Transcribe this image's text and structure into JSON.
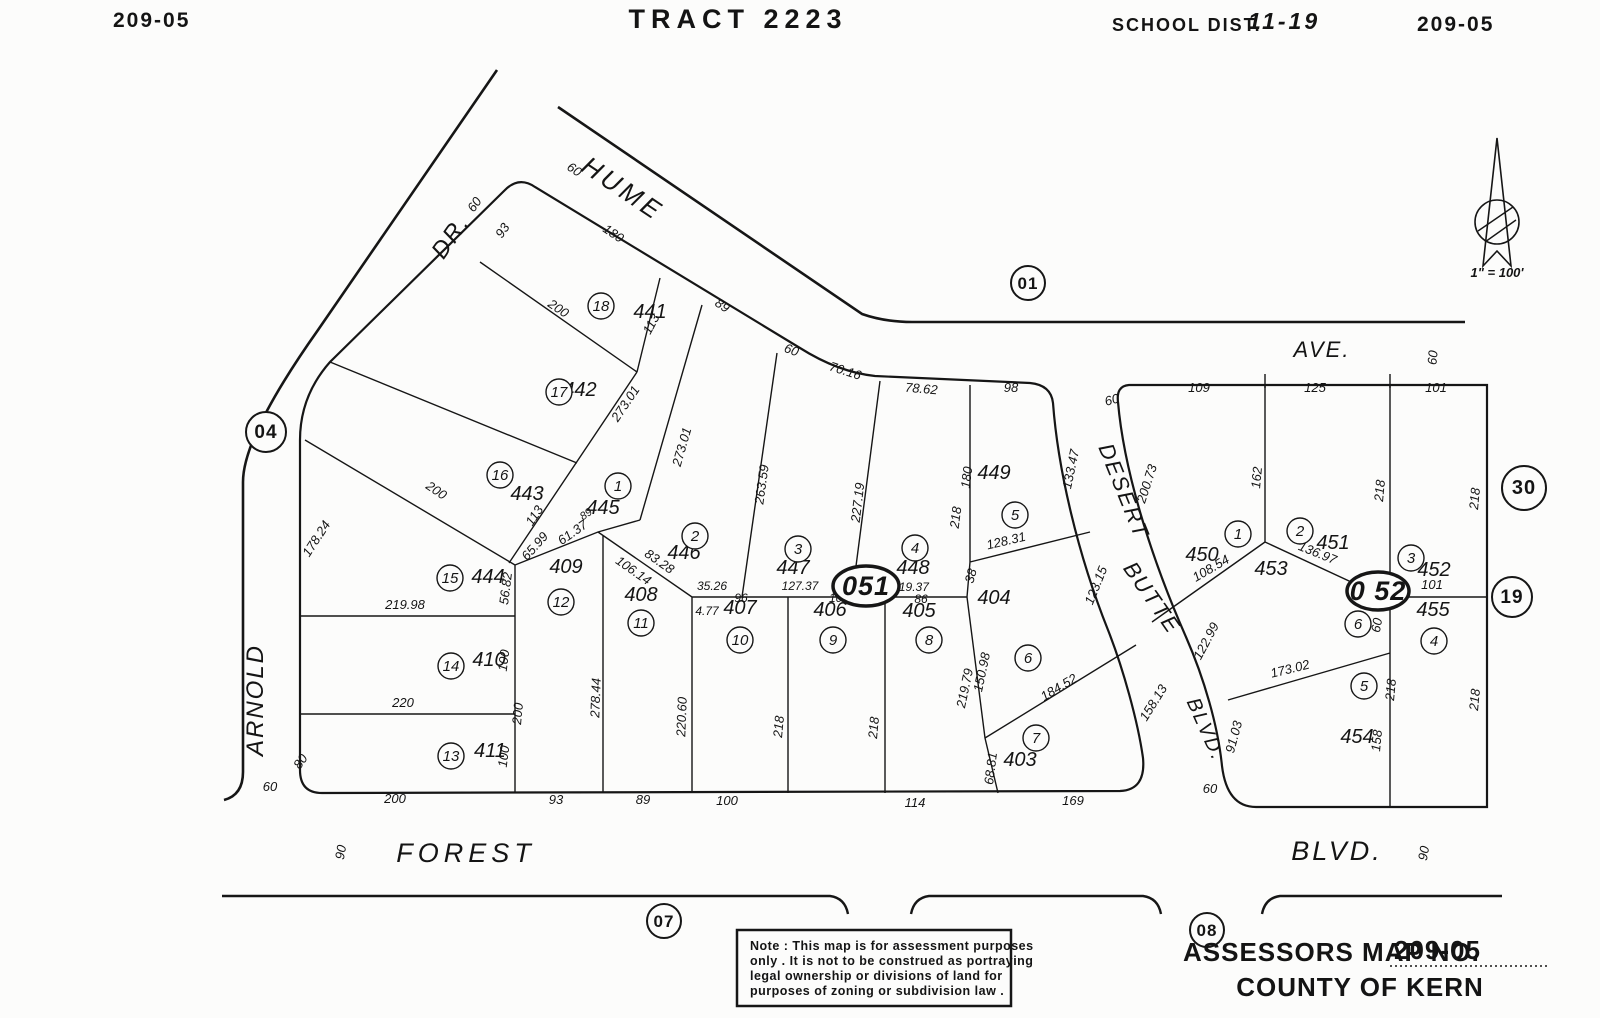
{
  "header": {
    "sheet_left": "209-05",
    "title": "TRACT 2223",
    "school_label": "SCHOOL DIST.",
    "school_value": "11-19",
    "sheet_right": "209-05"
  },
  "north_arrow": {
    "scale_text": "1\" = 100'"
  },
  "note": {
    "lines": [
      "Note : This map is for assessment purposes",
      "only . It is not to be construed as portraying",
      "legal ownership or divisions of land for",
      "purposes of zoning or subdivision law ."
    ]
  },
  "footer": {
    "assessors_label": "ASSESSORS MAP NO.",
    "assessors_value": "209-05",
    "county": "COUNTY OF KERN"
  },
  "map": {
    "labels": [
      {
        "t": "HUME",
        "x": 618,
        "y": 196,
        "r": 34,
        "c": "street",
        "s": 26,
        "ls": 4
      },
      {
        "t": "DR.",
        "x": 457,
        "y": 241,
        "r": -55,
        "c": "street",
        "s": 24
      },
      {
        "t": "AVE.",
        "x": 1322,
        "y": 357,
        "c": "street",
        "s": 22
      },
      {
        "t": "ARNOLD",
        "x": 263,
        "y": 700,
        "r": -90,
        "c": "street",
        "s": 24
      },
      {
        "t": "DESERT",
        "x": 1117,
        "y": 494,
        "r": 68,
        "c": "street",
        "s": 22
      },
      {
        "t": "BUTTE",
        "x": 1146,
        "y": 602,
        "r": 55,
        "c": "street",
        "s": 22
      },
      {
        "t": "BLVD.",
        "x": 1200,
        "y": 732,
        "r": 66,
        "c": "street",
        "s": 20
      },
      {
        "t": "FOREST",
        "x": 466,
        "y": 862,
        "c": "street",
        "s": 27,
        "ls": 5
      },
      {
        "t": "BLVD.",
        "x": 1337,
        "y": 860,
        "c": "street",
        "s": 27,
        "ls": 3
      },
      {
        "t": "441",
        "x": 650,
        "y": 318,
        "c": "parcel"
      },
      {
        "t": "442",
        "x": 580,
        "y": 396,
        "c": "parcel"
      },
      {
        "t": "443",
        "x": 527,
        "y": 500,
        "c": "parcel"
      },
      {
        "t": "444",
        "x": 488,
        "y": 583,
        "c": "parcel"
      },
      {
        "t": "445",
        "x": 603,
        "y": 514,
        "c": "parcel"
      },
      {
        "t": "446",
        "x": 684,
        "y": 559,
        "c": "parcel"
      },
      {
        "t": "447",
        "x": 793,
        "y": 574,
        "c": "parcel"
      },
      {
        "t": "448",
        "x": 913,
        "y": 574,
        "c": "parcel"
      },
      {
        "t": "449",
        "x": 994,
        "y": 479,
        "c": "parcel"
      },
      {
        "t": "450",
        "x": 1202,
        "y": 561,
        "c": "parcel"
      },
      {
        "t": "451",
        "x": 1333,
        "y": 549,
        "c": "parcel"
      },
      {
        "t": "452",
        "x": 1434,
        "y": 576,
        "c": "parcel"
      },
      {
        "t": "453",
        "x": 1271,
        "y": 575,
        "c": "parcel"
      },
      {
        "t": "454",
        "x": 1357,
        "y": 743,
        "c": "parcel"
      },
      {
        "t": "455",
        "x": 1433,
        "y": 616,
        "c": "parcel"
      },
      {
        "t": "403",
        "x": 1020,
        "y": 766,
        "c": "parcel"
      },
      {
        "t": "404",
        "x": 994,
        "y": 604,
        "c": "parcel"
      },
      {
        "t": "405",
        "x": 919,
        "y": 617,
        "c": "parcel"
      },
      {
        "t": "406",
        "x": 830,
        "y": 616,
        "c": "parcel"
      },
      {
        "t": "407",
        "x": 740,
        "y": 614,
        "c": "parcel"
      },
      {
        "t": "408",
        "x": 641,
        "y": 601,
        "c": "parcel"
      },
      {
        "t": "409",
        "x": 566,
        "y": 573,
        "c": "parcel"
      },
      {
        "t": "410",
        "x": 489,
        "y": 666,
        "c": "parcel"
      },
      {
        "t": "411",
        "x": 490,
        "y": 757,
        "c": "parcel"
      },
      {
        "t": "60",
        "x": 572,
        "y": 173,
        "r": 34
      },
      {
        "t": "180",
        "x": 611,
        "y": 237,
        "r": 34
      },
      {
        "t": "89",
        "x": 720,
        "y": 309,
        "r": 34
      },
      {
        "t": "60",
        "x": 790,
        "y": 354,
        "r": 20
      },
      {
        "t": "70.16",
        "x": 844,
        "y": 375,
        "r": 18
      },
      {
        "t": "78.62",
        "x": 921,
        "y": 393,
        "r": 5
      },
      {
        "t": "98",
        "x": 1011,
        "y": 392
      },
      {
        "t": "60",
        "x": 1113,
        "y": 404,
        "r": -15
      },
      {
        "t": "109",
        "x": 1199,
        "y": 392
      },
      {
        "t": "125",
        "x": 1315,
        "y": 392
      },
      {
        "t": "101",
        "x": 1436,
        "y": 392
      },
      {
        "t": "60",
        "x": 1437,
        "y": 358,
        "r": -85
      },
      {
        "t": "60",
        "x": 478,
        "y": 207,
        "r": -55
      },
      {
        "t": "93",
        "x": 506,
        "y": 233,
        "r": -55
      },
      {
        "t": "200",
        "x": 556,
        "y": 312,
        "r": 34
      },
      {
        "t": "113",
        "x": 655,
        "y": 326,
        "r": -62
      },
      {
        "t": "273.01",
        "x": 629,
        "y": 406,
        "r": -56
      },
      {
        "t": "273.01",
        "x": 686,
        "y": 448,
        "r": -74
      },
      {
        "t": "200",
        "x": 434,
        "y": 494,
        "r": 34
      },
      {
        "t": "178.24",
        "x": 320,
        "y": 541,
        "r": -57
      },
      {
        "t": "113",
        "x": 538,
        "y": 518,
        "r": -56
      },
      {
        "t": "65.99",
        "x": 538,
        "y": 549,
        "r": -48
      },
      {
        "t": "89",
        "x": 588,
        "y": 517,
        "r": -35,
        "s": 11
      },
      {
        "t": "61.37",
        "x": 575,
        "y": 536,
        "r": -35
      },
      {
        "t": "263.59",
        "x": 766,
        "y": 485,
        "r": -82
      },
      {
        "t": "227.19",
        "x": 862,
        "y": 503,
        "r": -83
      },
      {
        "t": "180",
        "x": 971,
        "y": 478,
        "r": -83
      },
      {
        "t": "218",
        "x": 960,
        "y": 518,
        "r": -83
      },
      {
        "t": "133.47",
        "x": 1075,
        "y": 470,
        "r": -78
      },
      {
        "t": "200.73",
        "x": 1151,
        "y": 485,
        "r": -72
      },
      {
        "t": "162",
        "x": 1261,
        "y": 478,
        "r": -85
      },
      {
        "t": "218",
        "x": 1384,
        "y": 491,
        "r": -85
      },
      {
        "t": "218",
        "x": 1479,
        "y": 499,
        "r": -85
      },
      {
        "t": "128.31",
        "x": 1007,
        "y": 545,
        "r": -13
      },
      {
        "t": "38",
        "x": 975,
        "y": 577,
        "r": -75
      },
      {
        "t": "123.15",
        "x": 1100,
        "y": 587,
        "r": -68
      },
      {
        "t": "108.54",
        "x": 1213,
        "y": 572,
        "r": -30
      },
      {
        "t": "136.97",
        "x": 1316,
        "y": 557,
        "r": 22
      },
      {
        "t": "101",
        "x": 1432,
        "y": 589
      },
      {
        "t": "56.82",
        "x": 510,
        "y": 589,
        "r": -83
      },
      {
        "t": "219.98",
        "x": 405,
        "y": 609
      },
      {
        "t": "106.14",
        "x": 631,
        "y": 574,
        "r": 35
      },
      {
        "t": "83.28",
        "x": 657,
        "y": 565,
        "r": 35
      },
      {
        "t": "35.26",
        "x": 712,
        "y": 590,
        "s": 12
      },
      {
        "t": "96",
        "x": 741,
        "y": 602,
        "s": 12
      },
      {
        "t": "4.77",
        "x": 707,
        "y": 615,
        "s": 12
      },
      {
        "t": "127.37",
        "x": 800,
        "y": 590,
        "s": 12
      },
      {
        "t": "100",
        "x": 839,
        "y": 602,
        "s": 12
      },
      {
        "t": "119.37",
        "x": 911,
        "y": 591,
        "s": 12
      },
      {
        "t": "86",
        "x": 921,
        "y": 603,
        "s": 12
      },
      {
        "t": "150.98",
        "x": 986,
        "y": 673,
        "r": -78
      },
      {
        "t": "219.79",
        "x": 969,
        "y": 689,
        "r": -78
      },
      {
        "t": "184.52",
        "x": 1061,
        "y": 691,
        "r": -31
      },
      {
        "t": "158.13",
        "x": 1157,
        "y": 705,
        "r": -58
      },
      {
        "t": "68.81",
        "x": 995,
        "y": 769,
        "r": -83
      },
      {
        "t": "122.99",
        "x": 1210,
        "y": 643,
        "r": -62
      },
      {
        "t": "91.03",
        "x": 1238,
        "y": 738,
        "r": -75
      },
      {
        "t": "173.02",
        "x": 1291,
        "y": 673,
        "r": -14
      },
      {
        "t": "60",
        "x": 1381,
        "y": 626,
        "r": -80
      },
      {
        "t": "218",
        "x": 1395,
        "y": 690,
        "r": -85
      },
      {
        "t": "218",
        "x": 1479,
        "y": 700,
        "r": -85
      },
      {
        "t": "158",
        "x": 1381,
        "y": 741,
        "r": -85
      },
      {
        "t": "278.44",
        "x": 600,
        "y": 698,
        "r": -88
      },
      {
        "t": "220.60",
        "x": 686,
        "y": 717,
        "r": -88
      },
      {
        "t": "218",
        "x": 783,
        "y": 727,
        "r": -85
      },
      {
        "t": "218",
        "x": 878,
        "y": 728,
        "r": -85
      },
      {
        "t": "100",
        "x": 508,
        "y": 661,
        "r": -83
      },
      {
        "t": "200",
        "x": 522,
        "y": 714,
        "r": -85
      },
      {
        "t": "100",
        "x": 508,
        "y": 757,
        "r": -83
      },
      {
        "t": "80",
        "x": 304,
        "y": 764,
        "r": -55
      },
      {
        "t": "220",
        "x": 403,
        "y": 707
      },
      {
        "t": "60",
        "x": 270,
        "y": 791
      },
      {
        "t": "200",
        "x": 395,
        "y": 803
      },
      {
        "t": "93",
        "x": 556,
        "y": 804
      },
      {
        "t": "89",
        "x": 643,
        "y": 804
      },
      {
        "t": "100",
        "x": 727,
        "y": 805
      },
      {
        "t": "114",
        "x": 915,
        "y": 807
      },
      {
        "t": "169",
        "x": 1073,
        "y": 805
      },
      {
        "t": "60",
        "x": 1210,
        "y": 793
      },
      {
        "t": "90",
        "x": 345,
        "y": 853,
        "r": -80
      },
      {
        "t": "90",
        "x": 1428,
        "y": 854,
        "r": -80
      }
    ],
    "lot_circles": [
      {
        "n": "18",
        "x": 601,
        "y": 306
      },
      {
        "n": "17",
        "x": 559,
        "y": 392
      },
      {
        "n": "16",
        "x": 500,
        "y": 475
      },
      {
        "n": "15",
        "x": 450,
        "y": 578
      },
      {
        "n": "14",
        "x": 451,
        "y": 666
      },
      {
        "n": "13",
        "x": 451,
        "y": 756
      },
      {
        "n": "12",
        "x": 561,
        "y": 602
      },
      {
        "n": "11",
        "x": 641,
        "y": 623
      },
      {
        "n": "10",
        "x": 740,
        "y": 640
      },
      {
        "n": "9",
        "x": 833,
        "y": 640
      },
      {
        "n": "8",
        "x": 929,
        "y": 640
      },
      {
        "n": "1",
        "x": 618,
        "y": 486
      },
      {
        "n": "2",
        "x": 695,
        "y": 536
      },
      {
        "n": "3",
        "x": 798,
        "y": 549
      },
      {
        "n": "4",
        "x": 915,
        "y": 548
      },
      {
        "n": "5",
        "x": 1015,
        "y": 515
      },
      {
        "n": "6",
        "x": 1028,
        "y": 658
      },
      {
        "n": "7",
        "x": 1036,
        "y": 738
      },
      {
        "n": "1",
        "x": 1238,
        "y": 534
      },
      {
        "n": "2",
        "x": 1300,
        "y": 531
      },
      {
        "n": "3",
        "x": 1411,
        "y": 558
      },
      {
        "n": "6",
        "x": 1358,
        "y": 624
      },
      {
        "n": "4",
        "x": 1434,
        "y": 641
      },
      {
        "n": "5",
        "x": 1364,
        "y": 686
      }
    ],
    "section_circles": [
      {
        "n": "01",
        "x": 1028,
        "y": 283,
        "r": 17,
        "s": 17
      },
      {
        "n": "04",
        "x": 266,
        "y": 432,
        "r": 20,
        "s": 19
      },
      {
        "n": "07",
        "x": 664,
        "y": 921,
        "r": 17,
        "s": 17
      },
      {
        "n": "08",
        "x": 1207,
        "y": 930,
        "r": 17,
        "s": 17
      },
      {
        "n": "19",
        "x": 1512,
        "y": 597,
        "r": 20,
        "s": 19
      },
      {
        "n": "30",
        "x": 1524,
        "y": 488,
        "r": 22,
        "s": 20
      }
    ],
    "block_ellipses": [
      {
        "t": "051",
        "x": 866,
        "y": 586,
        "rx": 33,
        "ry": 20
      },
      {
        "t": "0 52",
        "x": 1378,
        "y": 591,
        "rx": 31,
        "ry": 19
      }
    ]
  }
}
